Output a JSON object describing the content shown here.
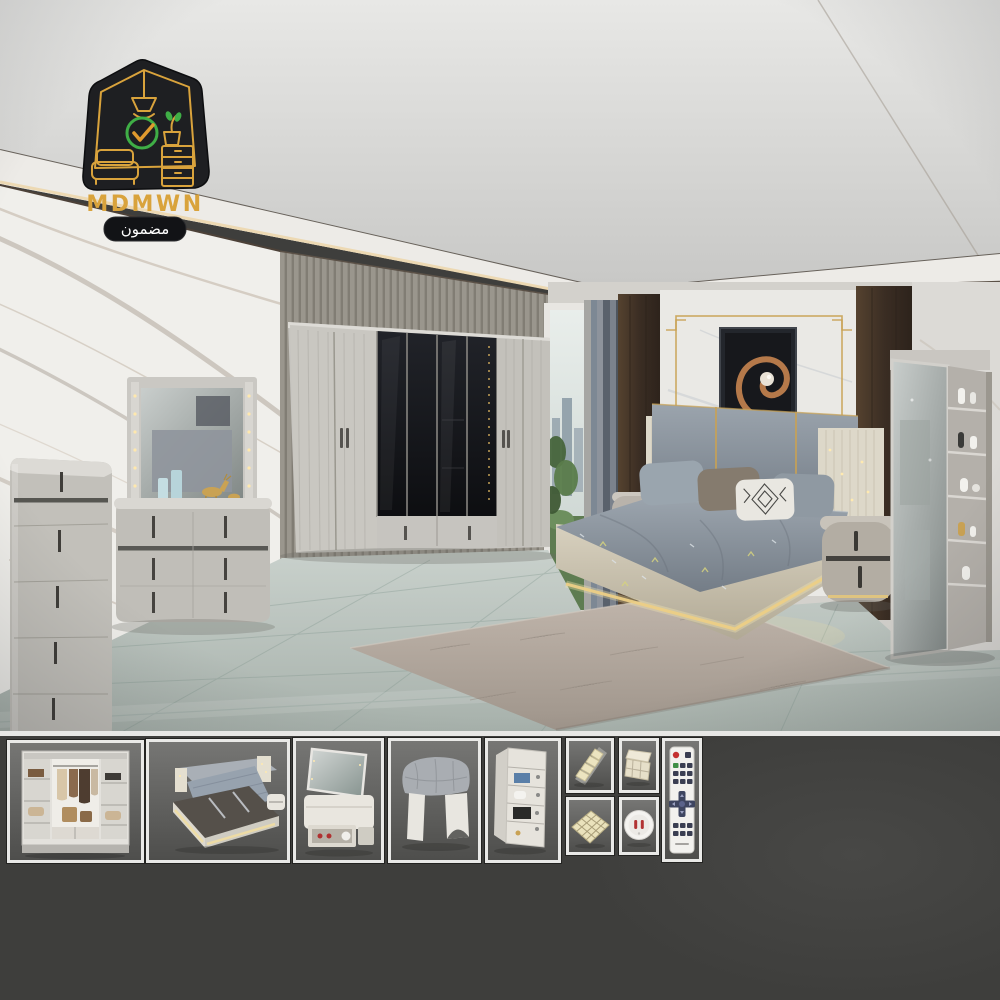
{
  "logo": {
    "brand": "MDMWN",
    "tagline": "مضمون",
    "badge_icons": [
      "house-outline",
      "pendant-lamp",
      "check-circle",
      "potted-plant",
      "dresser",
      "sofa"
    ],
    "colors": {
      "badge_bg": "#1e1f22",
      "line_gold": "#d9a33c",
      "check_green": "#3fae46",
      "tagline_bg": "#121316",
      "tagline_text": "#ffffff"
    }
  },
  "scene": {
    "items": [
      {
        "label": "tray ceiling with warm cove lighting"
      },
      {
        "label": "white marble accent wall"
      },
      {
        "label": "fluted wood slat wall panel"
      },
      {
        "label": "six-door wardrobe with smoked-glass center doors and lower drawers"
      },
      {
        "label": "window with city view and plant"
      },
      {
        "label": "striped gray-blue curtains"
      },
      {
        "label": "dark walnut wall panels"
      },
      {
        "label": "marble headboard wall with gold trim frame"
      },
      {
        "label": "spiral artwork in dark frame"
      },
      {
        "label": "upholstered bed with gold accents and LED base lighting"
      },
      {
        "label": "cream LED sparkle side panels"
      },
      {
        "label": "gray patterned bedspread with pillows"
      },
      {
        "label": "oval two-drawer nightstand left"
      },
      {
        "label": "oval two-drawer nightstand right"
      },
      {
        "label": "five-drawer chest"
      },
      {
        "label": "dresser with LED mirror, gold deer figurines and candles"
      },
      {
        "label": "standing mirror with display shelf column"
      },
      {
        "label": "gray wood plank flooring"
      },
      {
        "label": "taupe area rug"
      }
    ]
  },
  "gallery": {
    "items": [
      {
        "label": "open wardrobe interior with shelves and hanging clothes"
      },
      {
        "label": "storage bed with hydraulic lift-up base"
      },
      {
        "label": "dressing table with flip-up mirror and open drawer"
      },
      {
        "label": "upholstered dressing stool"
      },
      {
        "label": "tall cabinet with open shelf storage"
      },
      {
        "label": "tiered step shelf organizer"
      },
      {
        "label": "drawer organizer box"
      },
      {
        "label": "grid drawer divider insert"
      },
      {
        "label": "round socket night light"
      },
      {
        "label": "LED strip remote control"
      }
    ]
  },
  "colors": {
    "accent_gold": "#c9a254",
    "strip_bg": "#3e3e3c",
    "thumb_border": "#e9e9e7",
    "wall_marble": "#f0efeb",
    "glass_dark": "#15161a",
    "bed_platform": "#cbc3b1",
    "bedding_gray": "#8b95a0",
    "wood_wall": "#46362c",
    "floor_gray_green": "#b7c0bb"
  }
}
